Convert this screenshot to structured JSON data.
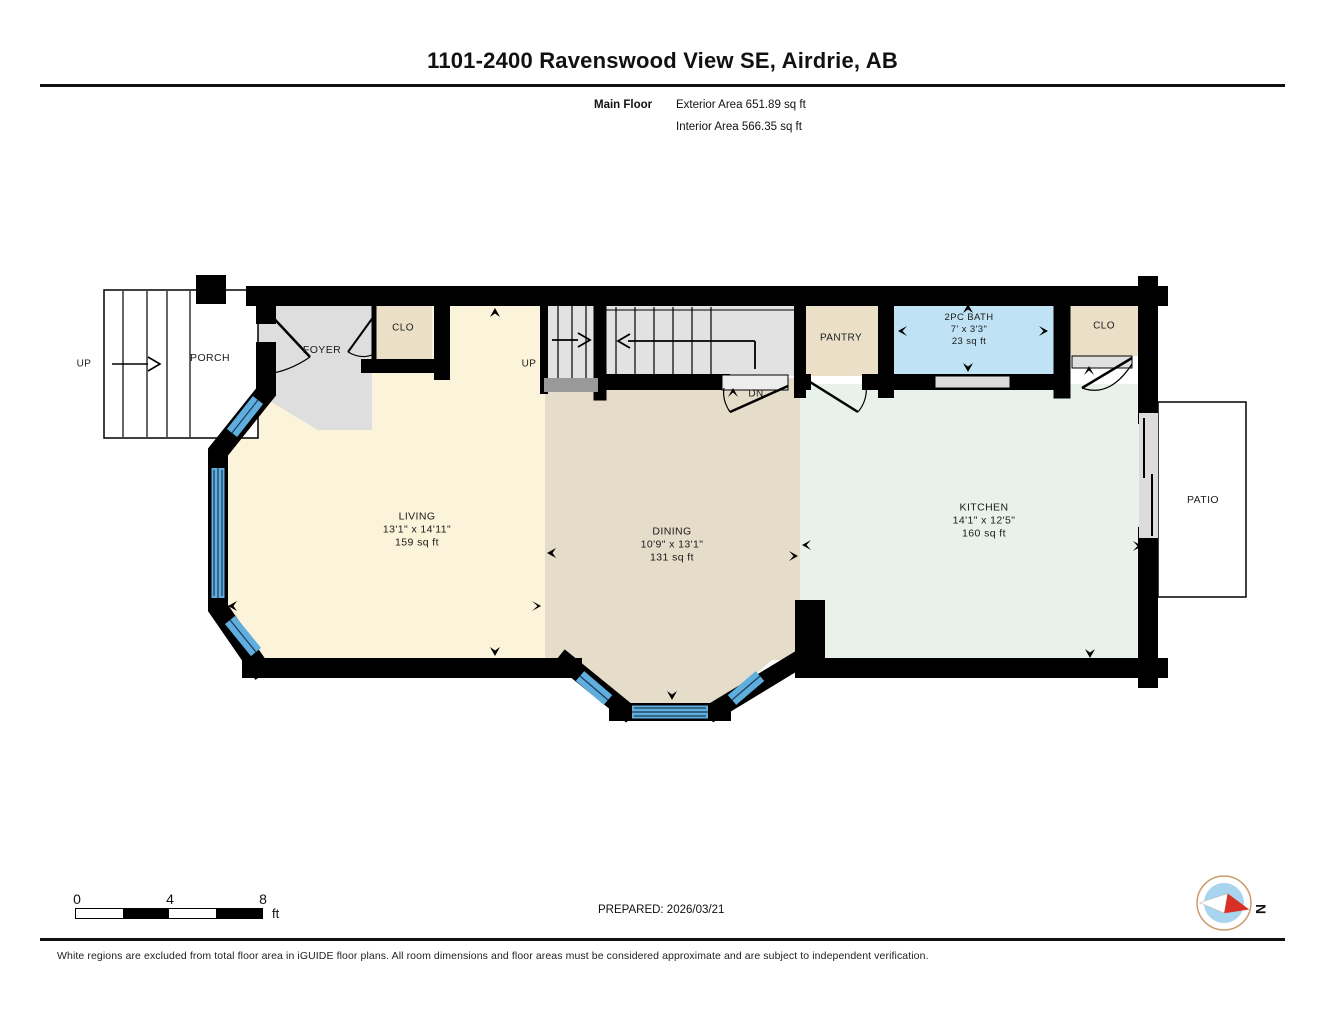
{
  "header": {
    "title": "1101-2400 Ravenswood View SE, Airdrie, AB",
    "floor_label": "Main Floor",
    "exterior_area": "Exterior Area 651.89 sq ft",
    "interior_area": "Interior Area 566.35 sq ft"
  },
  "rooms": {
    "living": {
      "name": "LIVING",
      "dims": "13'1\" x 14'11\"",
      "area": "159 sq ft"
    },
    "dining": {
      "name": "DINING",
      "dims": "10'9\" x 13'1\"",
      "area": "131 sq ft"
    },
    "kitchen": {
      "name": "KITCHEN",
      "dims": "14'1\" x 12'5\"",
      "area": "160 sq ft"
    },
    "bath": {
      "name": "2PC BATH",
      "dims": "7' x 3'3\"",
      "area": "23 sq ft"
    },
    "pantry": {
      "name": "PANTRY"
    },
    "foyer": {
      "name": "FOYER"
    },
    "porch": {
      "name": "PORCH"
    },
    "closet_left": {
      "name": "CLO"
    },
    "closet_right": {
      "name": "CLO"
    },
    "patio": {
      "name": "PATIO"
    }
  },
  "stairs": {
    "porch_up_label": "UP",
    "main_up_label": "UP",
    "down_label": "DN"
  },
  "scale_bar": {
    "tick0": "0",
    "tick4": "4",
    "tick8": "8",
    "unit": "ft"
  },
  "footer": {
    "prepared": "PREPARED: 2026/03/21",
    "compass_north": "N",
    "disclaimer": "White regions are excluded from total floor area in iGUIDE floor plans. All room dimensions and floor areas must be considered approximate and are subject to independent verification."
  },
  "colors": {
    "wall": "#000000",
    "living": "#FBF3DA",
    "dining": "#E6DCCA",
    "kitchen": "#E9F1EB",
    "bath": "#BFE2F4",
    "closet": "#EBDFC8",
    "foyer": "#DEDEDE",
    "stairs": "#E2E2E2",
    "landing": "#999999",
    "window": "#5FAEDE",
    "window_line": "#1A3A5C",
    "door_slab": "#DCDCDC",
    "compass_blue": "#A8D4F0",
    "compass_red": "#D93025",
    "compass_ring": "#CD9B6A"
  }
}
